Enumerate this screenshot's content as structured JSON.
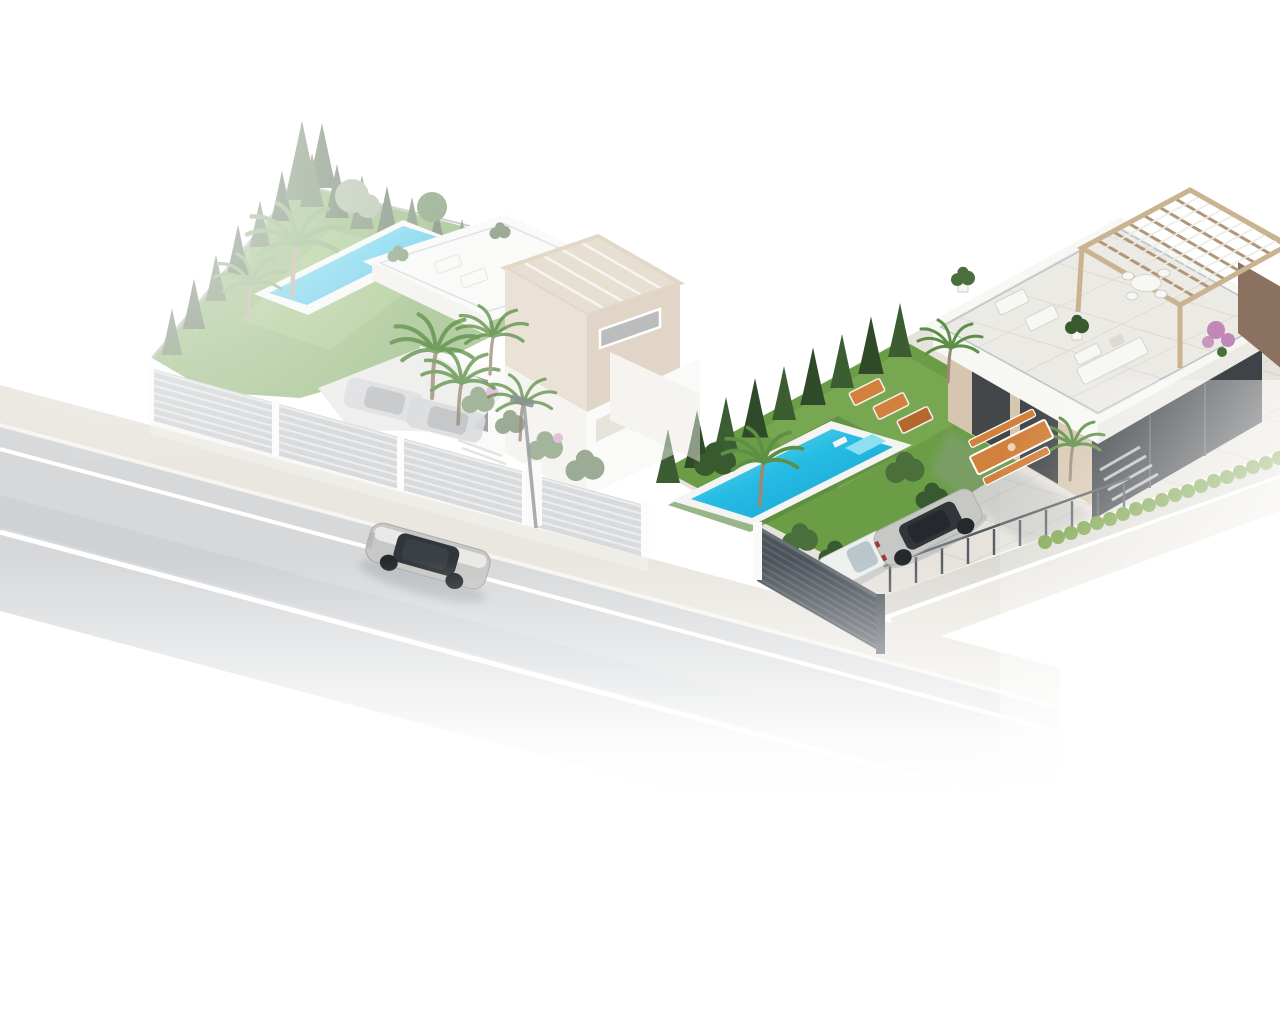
{
  "scene": {
    "type": "architectural-3d-render",
    "description": "Aerial isometric render of two modern white villas on a corner street: left plot with triangular garden, slim pool and two-storey villa; right plot with lawn, turquoise pool, single-storey villa with roof terrace and pergola; grey slat fences, parked cars and a silver car driving on the road; image fades to white at the edges",
    "objects": [
      "road",
      "sidewalk",
      "driving-car",
      "street-lamp",
      "left-plot",
      "left-garden",
      "left-pool",
      "left-villa",
      "left-driveway-cars",
      "left-street-fence",
      "right-plot",
      "right-lawn",
      "right-pool",
      "right-villa",
      "roof-terrace",
      "pergola",
      "sun-loungers",
      "outdoor-dining-set",
      "parked-sedan",
      "parked-white-car",
      "dark-slat-fence",
      "railing-fence",
      "hedges",
      "palm-trees",
      "conifer-trees"
    ]
  },
  "colors": {
    "road": "#d6d8da",
    "roadTrack": "#c8cbce",
    "roadLine": "#ffffff",
    "sidewalk": "#eae7e0",
    "curb": "#f7f5f0",
    "paving": "#e6e3dc",
    "pavingLine": "#d2cfc7",
    "grass": "#6b9d47",
    "grassLight": "#86b25e",
    "grassDark": "#55853a",
    "conifer": "#3c5c32",
    "coniferDark": "#2e4a28",
    "hedge": "#6f9c3a",
    "bush": "#4a6f3a",
    "bushDark": "#39592e",
    "olive": "#8da183",
    "pool": "#26bce4",
    "poolDeep": "#129fd0",
    "poolLight": "#8fdff2",
    "coping": "#f4f5f2",
    "white": "#f7f7f4",
    "whiteShade": "#eceae5",
    "whiteDark": "#dcdad4",
    "beige": "#d7c6af",
    "beigeShade": "#c3ac91",
    "pergola": "#c9b391",
    "pergolaDark": "#b0977a",
    "beamLight": "#efede6",
    "brown": "#8a7160",
    "charcoal": "#3f4347",
    "windowDark": "#44474a",
    "glass": "#b9c7cc",
    "fenceL": "#b2b7ba",
    "fenceLLine": "#d9dcde",
    "fenceD": "#4d535a",
    "fenceDLine": "#616b73",
    "post": "#fafaf8",
    "metal": "#565d63",
    "silver": "#c7c8c5",
    "silverHi": "#e9e9e7",
    "carGlass": "#31363b",
    "tire": "#26292c",
    "tail": "#a33a31",
    "whiteCar": "#eef0ef",
    "orange": "#d2813c",
    "orangeDark": "#b5682c",
    "pink": "#c287b7",
    "lamp": "#9aa0a4",
    "trunk": "#9c8a74",
    "palm": "#5d8f46",
    "palmDark": "#47703a",
    "shadow": "#9aa0a4",
    "background": "#ffffff"
  }
}
